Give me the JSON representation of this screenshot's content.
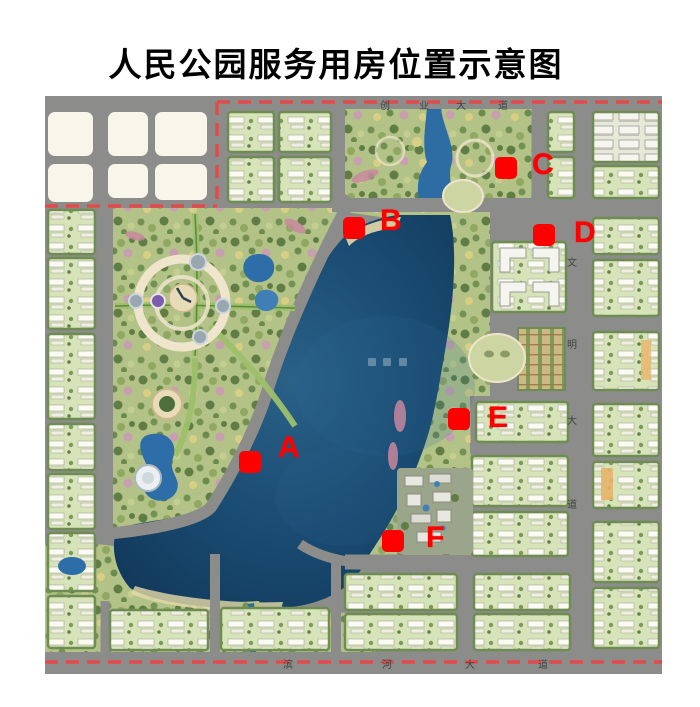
{
  "title": "人民公园服务用房位置示意图",
  "map": {
    "description": "park-master-plan-aerial-rendering",
    "marker_color": "#ff0000",
    "boundary_color": "#e14b4b",
    "lake_color": "#133f63",
    "markers": [
      {
        "label": "A",
        "x": 205,
        "y": 366,
        "lx": 243,
        "ly": 352
      },
      {
        "label": "B",
        "x": 309,
        "y": 132,
        "lx": 345,
        "ly": 125
      },
      {
        "label": "C",
        "x": 461,
        "y": 72,
        "lx": 497,
        "ly": 69
      },
      {
        "label": "D",
        "x": 499,
        "y": 139,
        "lx": 539,
        "ly": 137
      },
      {
        "label": "E",
        "x": 414,
        "y": 323,
        "lx": 453,
        "ly": 322
      },
      {
        "label": "F",
        "x": 348,
        "y": 445,
        "lx": 391,
        "ly": 442
      }
    ],
    "road_labels": [
      {
        "name": "top-road",
        "orient": "h",
        "chars": [
          "创",
          "业",
          "大",
          "道"
        ],
        "y": 9,
        "xs": [
          340,
          379,
          416,
          458
        ]
      },
      {
        "name": "right-road",
        "orient": "v",
        "chars": [
          "文",
          "明",
          "大",
          "道"
        ],
        "x": 527,
        "ys": [
          166,
          248,
          324,
          408
        ]
      },
      {
        "name": "bottom-road",
        "orient": "h",
        "chars": [
          "滨",
          "河",
          "大",
          "道"
        ],
        "y": 568,
        "xs": [
          243,
          342,
          425,
          498
        ]
      }
    ]
  }
}
